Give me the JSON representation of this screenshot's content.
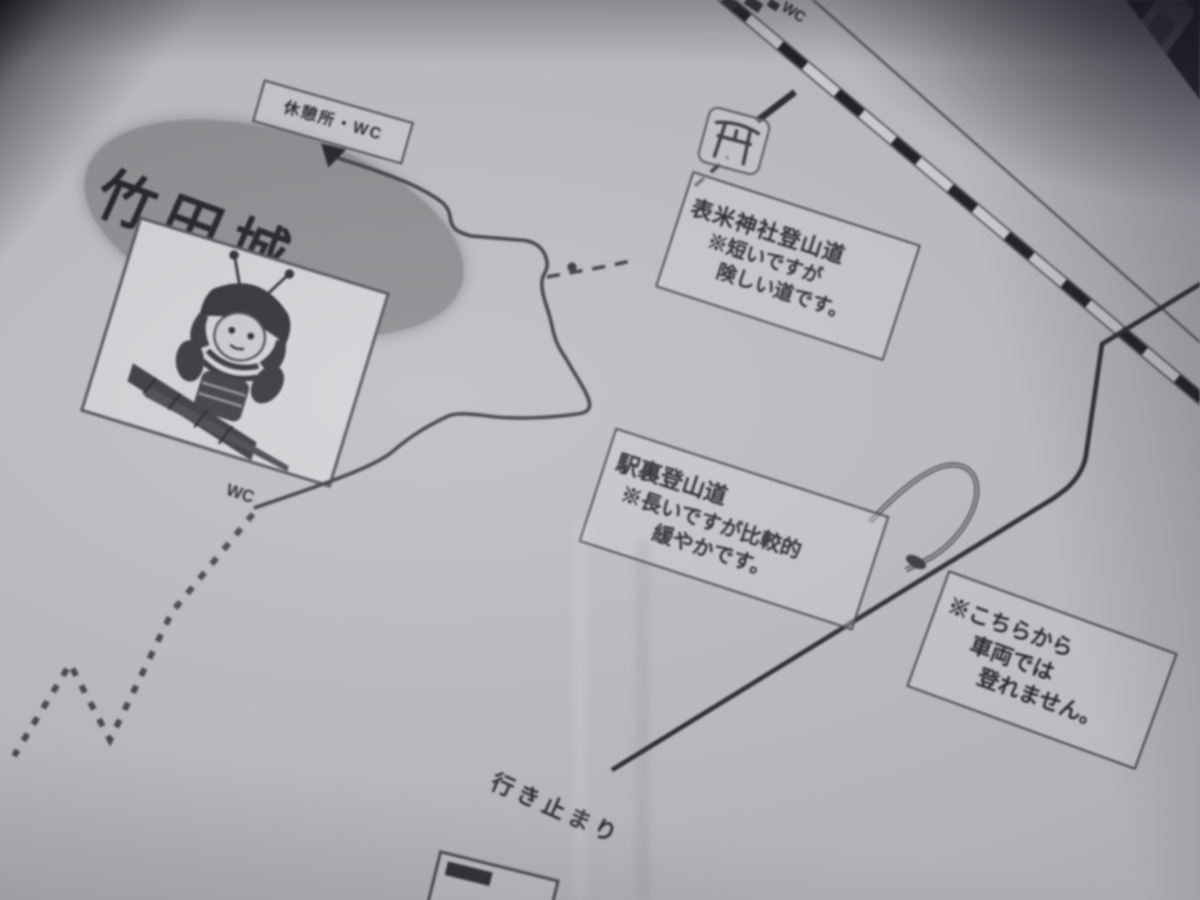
{
  "labels": {
    "castle": "竹田城",
    "wc": "WC",
    "top_partial": "WC",
    "dead_end": "行き止まり"
  },
  "signs": {
    "rest_area": "休憩所・WC",
    "omai_trail": {
      "line1": "表米神社登山道",
      "line2": "※短いですが",
      "line3": "険しい道です。"
    },
    "ekiura_trail": {
      "line1": "駅裏登山道",
      "line2": "※長いですが比較的",
      "line3": "緩やかです。"
    },
    "no_vehicles": {
      "line1": "※こちらから",
      "line2": "車両では",
      "line3": "登れません。"
    }
  },
  "icons": {
    "torii": "torii-shrine-icon",
    "samurai": "samurai-warrior-illustration",
    "railway": "railway-track-line"
  },
  "colors": {
    "paper": "#bdbdc2",
    "ink": "#2b2b2e",
    "oval_fill": "#8c8c90",
    "photo_shadow": "#2e2e33"
  }
}
